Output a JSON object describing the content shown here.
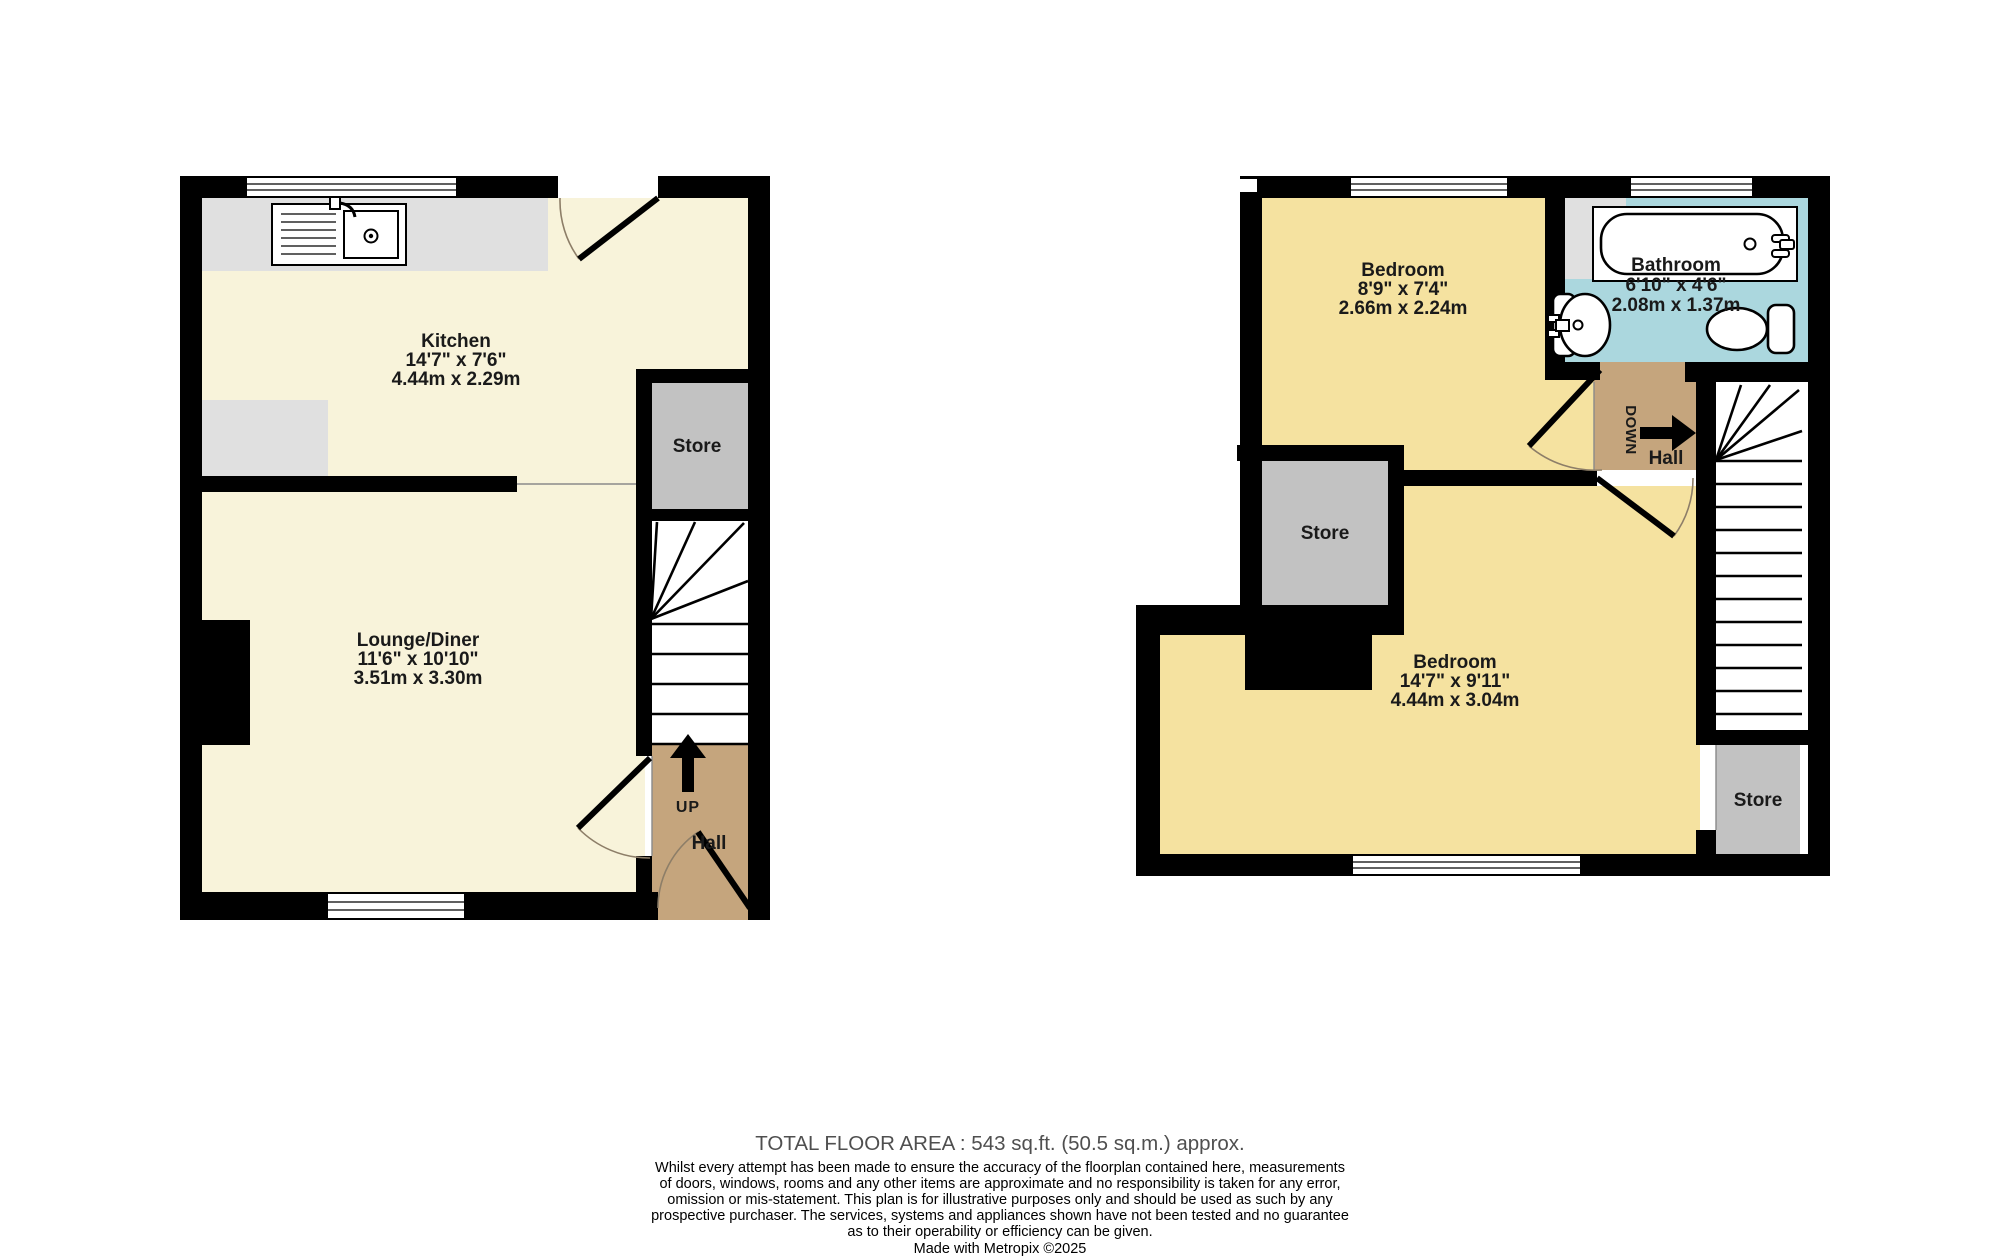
{
  "ground_floor": {
    "kitchen": {
      "name": "Kitchen",
      "imperial": "14'7\" x 7'6\"",
      "metric": "4.44m x 2.29m"
    },
    "lounge": {
      "name": "Lounge/Diner",
      "imperial": "11'6\" x 10'10\"",
      "metric": "3.51m x 3.30m"
    },
    "store": {
      "name": "Store"
    },
    "hall": {
      "name": "Hall"
    },
    "stairs": {
      "direction": "UP"
    }
  },
  "first_floor": {
    "bedroom_small": {
      "name": "Bedroom",
      "imperial": "8'9\" x 7'4\"",
      "metric": "2.66m x 2.24m"
    },
    "bathroom": {
      "name": "Bathroom",
      "imperial": "6'10\" x 4'6\"",
      "metric": "2.08m x 1.37m"
    },
    "bedroom_large": {
      "name": "Bedroom",
      "imperial": "14'7\" x 9'11\"",
      "metric": "4.44m x 3.04m"
    },
    "store_upper": {
      "name": "Store"
    },
    "store_lower": {
      "name": "Store"
    },
    "hall": {
      "name": "Hall"
    },
    "stairs": {
      "direction": "DOWN"
    }
  },
  "footer": {
    "total_area": "TOTAL FLOOR AREA : 543 sq.ft. (50.5 sq.m.) approx.",
    "disclaimer": [
      "Whilst every attempt has been made to ensure the accuracy of the floorplan contained here, measurements",
      "of doors, windows, rooms and any other items are approximate and no responsibility is taken for any error,",
      "omission or mis-statement. This plan is for illustrative purposes only and should be used as such by any",
      "prospective purchaser. The services, systems and appliances shown have not been tested and no guarantee",
      "as to their operability or efficiency can be given."
    ],
    "credit": "Made with Metropix ©2025"
  },
  "colors": {
    "wall": "#000000",
    "ground_room": "#f8f3da",
    "first_room": "#f5e2a0",
    "hall_tan": "#c5a57d",
    "bath_blue": "#abd7de",
    "store_gray": "#c2c2c2",
    "counter_gray": "#e0e0e0"
  }
}
